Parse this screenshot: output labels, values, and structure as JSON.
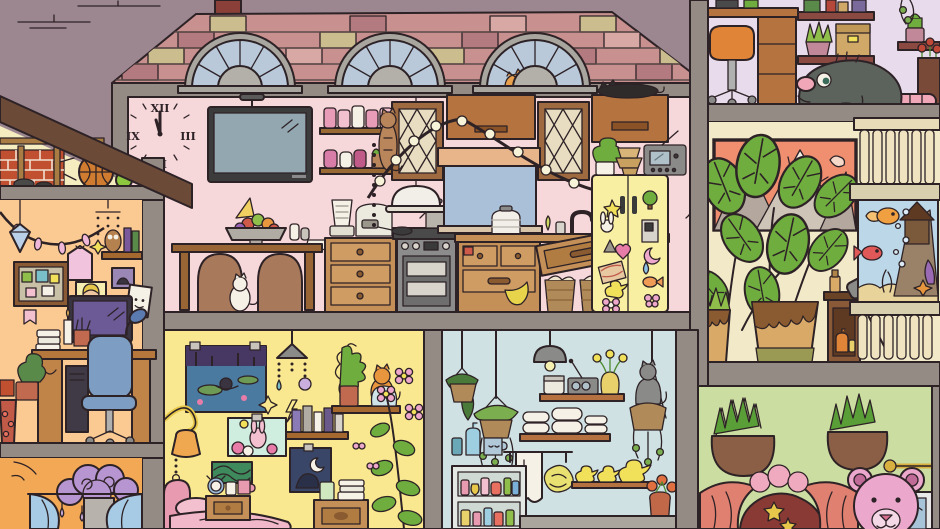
{
  "app": {
    "type": "cozy-dollhouse-cross-section-illustration",
    "description": "Cut-away view of a house with kitchen, bedrooms, bathroom, plant room, balcony aquarium and play room; hidden cats and a giant rat."
  },
  "palette": {
    "sky": "#9c8791",
    "roof_brick": "#c8908e",
    "brick_tan": "#ccbd8e",
    "brick_dark": "#b37b80",
    "brick_light": "#d8a8a4",
    "divider_gray": "#948c84",
    "kitchen_wall": "#f6d7da",
    "attic_wall": "#f5ecc0",
    "left_wall": "#fbca92",
    "orange_wall": "#f2a854",
    "yellow_wall": "#f9e88f",
    "bath_wall": "#cfe1e2",
    "green_wall": "#ccdda2",
    "lavender_wall": "#e8dcec",
    "plant_room_wall": "#f2e9c8",
    "fridge_yellow": "#f9efa3",
    "wood_light": "#c49058",
    "wood_mid": "#b5743f",
    "wood_dark": "#9a6535",
    "leaf_green": "#6fae3e",
    "water_blue": "#bcd7e8",
    "curtain_red": "#e08070",
    "teddy_pink": "#eba8cc",
    "rat_gray": "#5c625c",
    "window_glass": "#b9c9da"
  },
  "rooms": {
    "kitchen": {
      "name": "kitchen",
      "clock": {
        "twelve": "XII",
        "three": "III",
        "six": "VI",
        "nine": "IX"
      },
      "objects": [
        "wall clock",
        "ceiling lamp",
        "flat-screen TV",
        "jar shelves",
        "dining table",
        "two chairs",
        "fruit bowl",
        "party hat",
        "salt and pepper",
        "white cat under table",
        "blender",
        "rice cooker",
        "drawer cabinet",
        "stove with kettle",
        "frying pan",
        "dome lamp",
        "lattice cabinets",
        "tabby cat climbing cabinet",
        "window with blind",
        "string lights",
        "sink faucet",
        "falling drawer",
        "bread baskets",
        "yellow fridge with magnets",
        "radio",
        "stacked bowls",
        "potted plant",
        "black cat sleeping on cabinet"
      ],
      "fridge_magnets": [
        "star",
        "bunny",
        "triangle",
        "heart",
        "bacon photo",
        "duck",
        "flower",
        "tree",
        "dispenser",
        "moon",
        "drop",
        "fish",
        "butterfly"
      ]
    },
    "attic": {
      "name": "attic-nook",
      "objects": [
        "exposed brick",
        "wood studs",
        "basketball",
        "tennis ball",
        "two mice"
      ]
    },
    "left_bedroom": {
      "name": "study-bedroom",
      "objects": [
        "string lights",
        "hanging gem",
        "crystal mobile",
        "wall shelf with books",
        "owl figurine",
        "hanging pink shirt",
        "corkboard",
        "posters",
        "computer monitor",
        "desk lamp",
        "desk",
        "office chair",
        "PC tower",
        "books",
        "candle",
        "pencil cup",
        "plant",
        "flower pot"
      ]
    },
    "orange_bedroom": {
      "name": "canopy-bedroom",
      "objects": [
        "purple cloud canopy",
        "hanging raindrops",
        "blue curtains",
        "mirror"
      ]
    },
    "yellow_bedroom": {
      "name": "yellow-bedroom",
      "objects": [
        "pond painting",
        "crystal chandelier",
        "bunny painting",
        "green poster",
        "moon poster",
        "book shelf",
        "plant shelf",
        "orange cat",
        "blue jar",
        "wall lamp",
        "pink bed",
        "nightstand with alarm clock and mugs",
        "side table with cup and books",
        "tall flowering plant",
        "butterflies"
      ]
    },
    "bathroom": {
      "name": "bathroom-laundry",
      "objects": [
        "hanging plants",
        "pendant lamp",
        "shelf with jar radio and vase",
        "gray cat on hanging basket",
        "rolled towels",
        "towel rack",
        "hanging towel",
        "loofah",
        "three rubber ducks",
        "shampoo bottles",
        "mug",
        "toiletry shelving",
        "vase with orange flowers",
        "bathtub rim"
      ]
    },
    "office_upstairs": {
      "name": "upstairs-office",
      "objects": [
        "desk",
        "orange swivel stool",
        "wall shelves",
        "aloe plant",
        "cardboard box",
        "cactus",
        "hanging vine",
        "red flowers",
        "giant gray rat"
      ]
    },
    "plant_room": {
      "name": "monstera-room",
      "objects": [
        "mountain sunset painting",
        "monstera plants",
        "drippy glazed pots",
        "small cabinet with bottles",
        "spray bottle",
        "shovel"
      ]
    },
    "balcony": {
      "name": "balcony-aquarium",
      "objects": [
        "balustrade",
        "fish tank",
        "goldfish",
        "red fish",
        "castle rock",
        "seaweed",
        "starfish",
        "bubbles"
      ]
    },
    "playroom": {
      "name": "play-room",
      "objects": [
        "wall planters",
        "puppet theater with curtains",
        "gold stars",
        "pom poms",
        "pink teddy bear",
        "picture frame",
        "brass trumpet"
      ]
    }
  }
}
